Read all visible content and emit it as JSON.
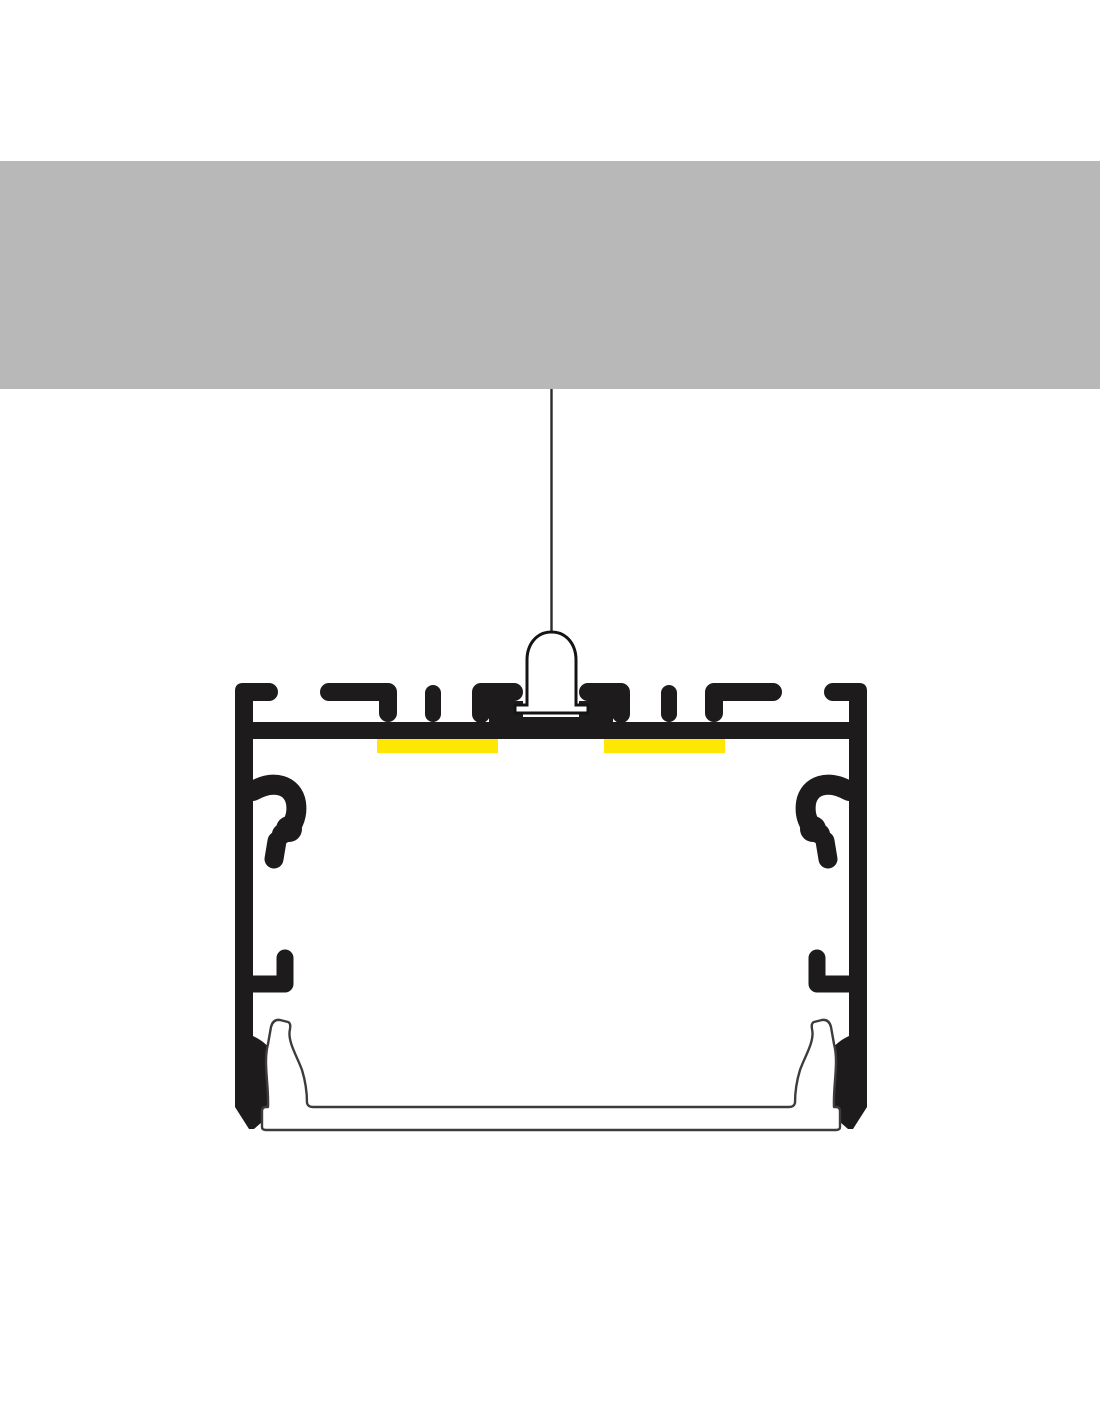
{
  "scene": {
    "type": "technical-diagram",
    "subject": "suspended-led-aluminium-profile-cross-section",
    "components": [
      "ceiling-slab",
      "suspension-wire",
      "suspension-mount",
      "mounting-profile",
      "t-slot-channels",
      "led-strip-left",
      "led-strip-right",
      "clip-hook-upper-left",
      "clip-hook-upper-right",
      "clip-hook-middle-left",
      "clip-hook-middle-right",
      "diffuser"
    ]
  },
  "colors": {
    "background": "#ffffff",
    "ceiling": "#b8b8b8",
    "profile": "#1d1b1b",
    "led_strip": "#ffe603",
    "fixture_fill": "#ffffff",
    "fixture_outline": "#141414",
    "diffuser_fill": "#ffffff",
    "diffuser_outline": "#3c3c3c",
    "wire": "#2b2b2b"
  }
}
